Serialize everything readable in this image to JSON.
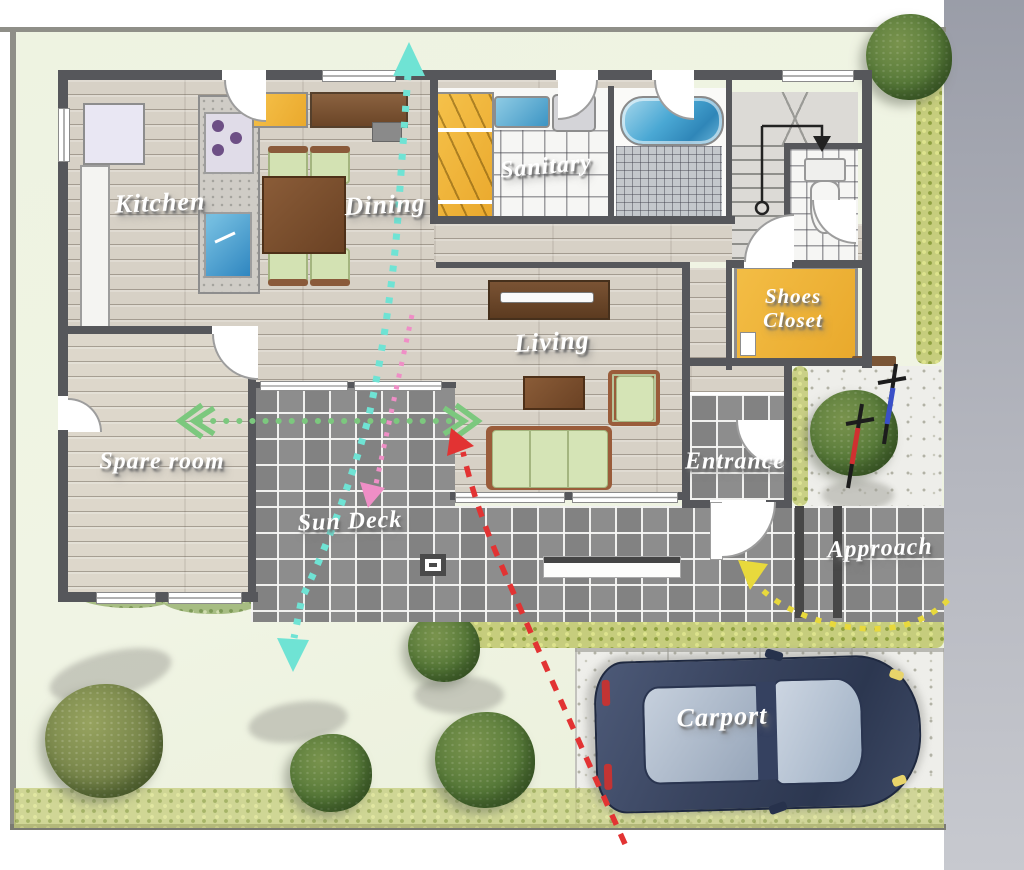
{
  "plan": {
    "title": "house floor plan illustration",
    "rooms": [
      {
        "id": "kitchen",
        "label": "Kitchen"
      },
      {
        "id": "dining",
        "label": "Dining"
      },
      {
        "id": "sanitary",
        "label": "Sanitary"
      },
      {
        "id": "shoes-closet",
        "label": "Shoes Closet"
      },
      {
        "id": "living",
        "label": "Living"
      },
      {
        "id": "spare-room",
        "label": "Spare room"
      },
      {
        "id": "entrance",
        "label": "Entrance"
      },
      {
        "id": "sun-deck",
        "label": "Sun Deck"
      },
      {
        "id": "approach",
        "label": "Approach"
      },
      {
        "id": "carport",
        "label": "Carport"
      }
    ],
    "flows": [
      {
        "name": "breeze-path-vertical",
        "color": "#6fe3d4",
        "style": "dotted"
      },
      {
        "name": "indoor-flow-pink",
        "color": "#ef8ec6",
        "style": "dotted"
      },
      {
        "name": "cross-breeze-horizontal",
        "color": "#7cc87e",
        "style": "dotted"
      },
      {
        "name": "car-access-red",
        "color": "#e23333",
        "style": "dashed"
      },
      {
        "name": "approach-path-yellow",
        "color": "#e8d93c",
        "style": "dotted"
      }
    ],
    "colors": {
      "wood_floor": "#d7d1c6",
      "deck_tile": "#8d8d8d",
      "closet_yellow": "#efb73c",
      "water_blue": "#4aa8d4",
      "garden_green": "#eef3e1",
      "hedge_green": "#c6cd7d",
      "car_body_navy": "#3a4560",
      "bike_red": "#d03030",
      "bike_blue": "#3a50c8",
      "wall_gray": "#56575b",
      "margin_gray": "#a8abb4"
    }
  }
}
